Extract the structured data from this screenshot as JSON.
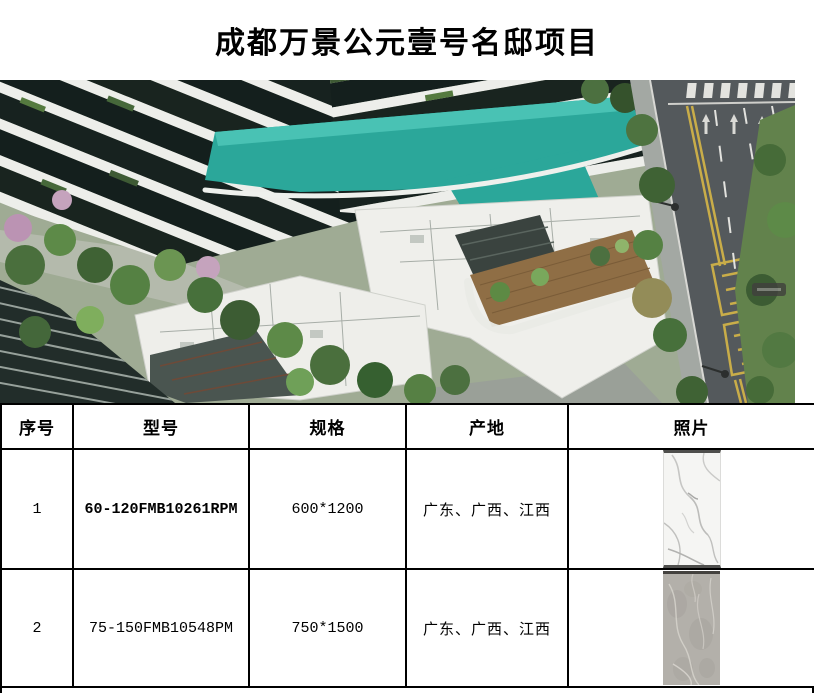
{
  "title": {
    "text": "成都万景公元壹号名邸项目"
  },
  "hero": {
    "name": "aerial-render",
    "description": "项目鸟瞰效果图"
  },
  "table": {
    "headers": [
      "序号",
      "型号",
      "规格",
      "产地",
      "照片"
    ],
    "rows": [
      {
        "no": "1",
        "model": "60-120FMB10261RPM",
        "spec": "600*1200",
        "origin": "广东、广西、江西",
        "photo": "white-marble-tile"
      },
      {
        "no": "2",
        "model": "75-150FMB10548PM",
        "spec": "750*1500",
        "origin": "广东、广西、江西",
        "photo": "gray-marble-tile"
      }
    ]
  },
  "colors": {
    "pool_teal": "#2ba79a",
    "road_gray": "#54595c",
    "lane_yellow": "#c9ad49",
    "plan_white": "#efefeb",
    "tree_green": "#4c7040"
  }
}
